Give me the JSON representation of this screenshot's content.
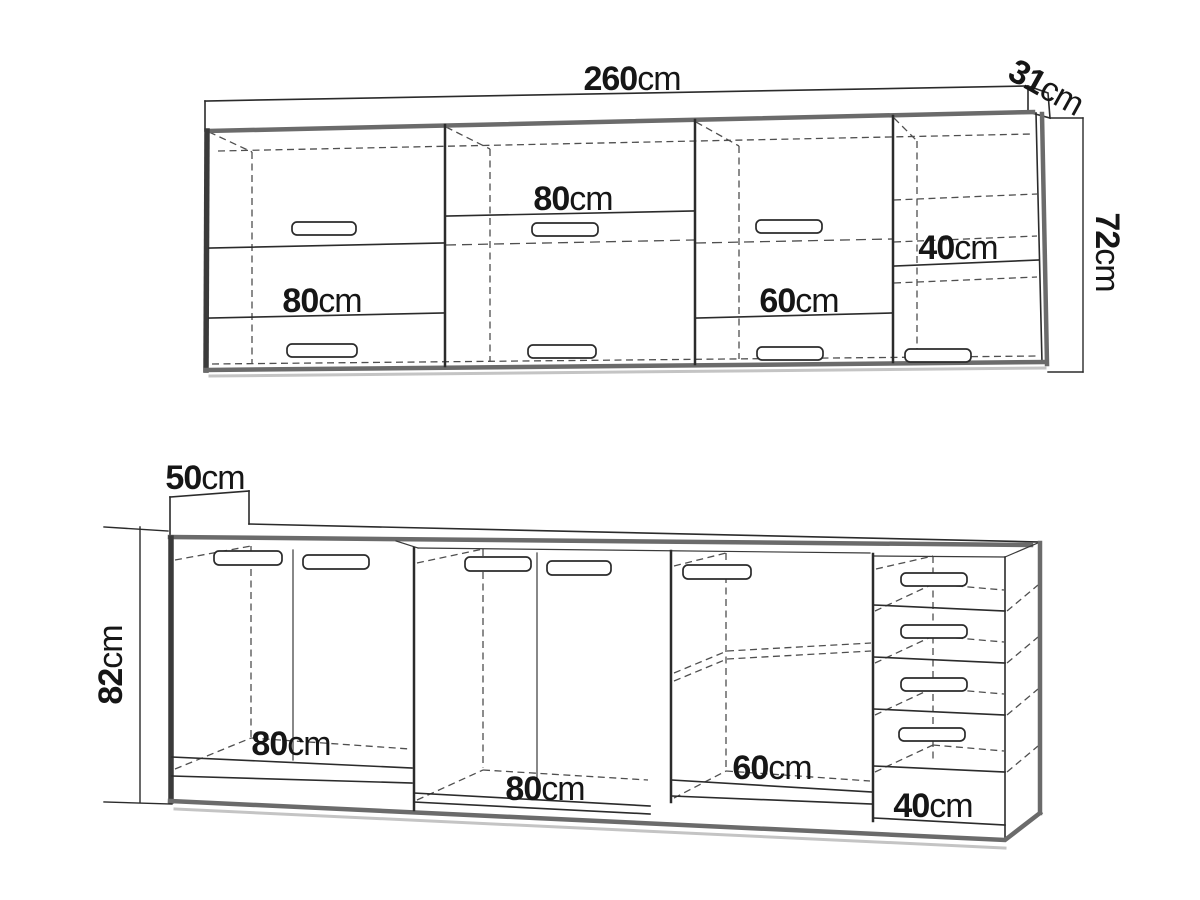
{
  "diagram": {
    "background": "#ffffff",
    "line_color": "#2b2b2b",
    "thick_edge_color": "#6b6b6b",
    "dark_edge_color": "#3a3a3a",
    "label_color": "#161616"
  },
  "wall_cabinets": {
    "total_width": {
      "value": "260",
      "unit": "cm"
    },
    "depth": {
      "value": "31",
      "unit": "cm"
    },
    "height": {
      "value": "72",
      "unit": "cm"
    },
    "sections": [
      {
        "width": {
          "value": "80",
          "unit": "cm"
        }
      },
      {
        "width": {
          "value": "80",
          "unit": "cm"
        }
      },
      {
        "width": {
          "value": "60",
          "unit": "cm"
        }
      },
      {
        "width": {
          "value": "40",
          "unit": "cm"
        }
      }
    ]
  },
  "base_cabinets": {
    "depth": {
      "value": "50",
      "unit": "cm"
    },
    "height": {
      "value": "82",
      "unit": "cm"
    },
    "sections": [
      {
        "width": {
          "value": "80",
          "unit": "cm"
        }
      },
      {
        "width": {
          "value": "80",
          "unit": "cm"
        }
      },
      {
        "width": {
          "value": "60",
          "unit": "cm"
        }
      },
      {
        "width": {
          "value": "40",
          "unit": "cm"
        }
      }
    ]
  }
}
